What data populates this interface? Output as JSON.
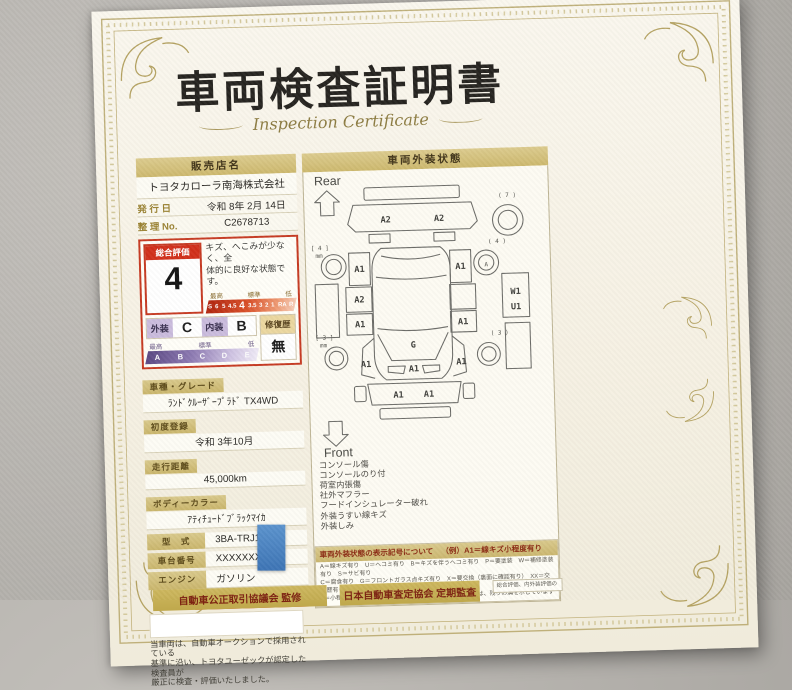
{
  "title": "車両検査証明書",
  "subtitle": "Inspection Certificate",
  "left": {
    "dealer_label": "販売店名",
    "dealer_name": "トヨタカローラ南海株式会社",
    "issue_label": "発 行 日",
    "issue_value": "令和 8年 2月 14日",
    "ref_label": "整 理 No.",
    "ref_value": "C2678713",
    "rating": {
      "label": "総合評価",
      "value": "4",
      "comment_line1": "キズ、へこみが少なく、全",
      "comment_line2": "体的に良好な状態です。",
      "scale_captions": [
        "最高",
        "標準",
        "低"
      ],
      "scale_values": [
        "S",
        "6",
        "5",
        "4.5",
        "4",
        "3.5",
        "3",
        "2",
        "1",
        "RA",
        "R"
      ],
      "exterior_label": "外装",
      "exterior_value": "C",
      "interior_label": "内装",
      "interior_value": "B",
      "grade_captions": [
        "最高",
        "標準",
        "低"
      ],
      "grade_values": [
        "A",
        "B",
        "C",
        "D",
        "E"
      ],
      "repair_label": "修復歴",
      "repair_value": "無"
    },
    "fields": [
      {
        "label": "車種・グレード",
        "value": "ﾗﾝﾄﾞｸﾙｰｻﾞｰﾌﾟﾗﾄﾞ TX4WD",
        "layout": "stacked"
      },
      {
        "label": "初度登録",
        "value": "令和 3年10月",
        "layout": "stacked"
      },
      {
        "label": "走行距離",
        "value": "45,000km",
        "layout": "stacked"
      },
      {
        "label": "ボディーカラー",
        "value": "ｱﾃｨﾁｭｰﾄﾞﾌﾞﾗｯｸﾏｲｶ",
        "layout": "stacked"
      },
      {
        "label": "型　式",
        "value": "3BA-TRJ150W",
        "layout": "inline"
      },
      {
        "label": "車台番号",
        "value": "XXXXXXX220",
        "layout": "inline"
      },
      {
        "label": "エンジン",
        "value": "ガソリン",
        "layout": "inline"
      }
    ],
    "inspector_badge": "トヨタ認定車両検査員",
    "disclaimer": [
      "当車両は、自動車オークションで採用されている",
      "基準に沿い、トヨタユーゼックが認定した検査員が",
      "厳正に検査・評価いたしました。"
    ]
  },
  "right": {
    "header": "車両外装状態",
    "rear_label": "Rear",
    "front_label": "Front",
    "diagram_labels": [
      {
        "t": "A2",
        "x": 82,
        "y": 55
      },
      {
        "t": "A2",
        "x": 138,
        "y": 55
      },
      {
        "t": "( 7 )",
        "x": 210,
        "y": 32,
        "small": true
      },
      {
        "t": "[ 4 ]",
        "x": 12,
        "y": 82,
        "small": true
      },
      {
        "t": "mm",
        "x": 11,
        "y": 90,
        "small": true
      },
      {
        "t": "( 4 )",
        "x": 198,
        "y": 80,
        "small": true
      },
      {
        "t": "A",
        "x": 186,
        "y": 104,
        "small": true
      },
      {
        "t": "A1",
        "x": 53,
        "y": 106
      },
      {
        "t": "A1",
        "x": 159,
        "y": 106
      },
      {
        "t": "A2",
        "x": 52,
        "y": 138
      },
      {
        "t": "A1",
        "x": 52,
        "y": 164
      },
      {
        "t": "A1",
        "x": 160,
        "y": 164
      },
      {
        "t": "W1",
        "x": 216,
        "y": 134
      },
      {
        "t": "U1",
        "x": 216,
        "y": 150
      },
      {
        "t": "G",
        "x": 107,
        "y": 187
      },
      {
        "t": "A1",
        "x": 107,
        "y": 212
      },
      {
        "t": "A1",
        "x": 57,
        "y": 206
      },
      {
        "t": "A1",
        "x": 157,
        "y": 206
      },
      {
        "t": "[ 3 ]",
        "x": 14,
        "y": 176,
        "small": true
      },
      {
        "t": "mm",
        "x": 13,
        "y": 184,
        "small": true
      },
      {
        "t": "( 3 )",
        "x": 198,
        "y": 176,
        "small": true
      },
      {
        "t": "A1",
        "x": 90,
        "y": 239
      },
      {
        "t": "A1",
        "x": 122,
        "y": 239
      }
    ],
    "notes": [
      "コンソール傷",
      "コンソールのり付",
      "荷室内張傷",
      "社外マフラー",
      "フードインシュレーター破れ",
      "外装うすい線キズ",
      "外装しみ"
    ],
    "legend_title": "車両外装状態の表示記号について",
    "legend_example": "（例）A1＝線キズ小程度有り",
    "legend_lines": [
      "A＝線キズ有り　U＝ヘコミ有り　B＝キズを伴うヘコミ有り　P＝要塗装　W＝補修塗装有り　S＝サビ有り",
      "C＝腐食有り　G＝フロントガラス点キズ有り　X＝要交換（裏面に確認有り）　XX＝交換歴有り",
      "1＝小程度　2＝中程度　3＝中程度以上　＊タイヤ溝の数字は、残りの溝を示しています"
    ]
  },
  "footer": {
    "box1": "自動車公正取引協議会 監修",
    "box2": "日本自動車査定協会 定期監査",
    "note": "総合評価、内外装評価の"
  }
}
